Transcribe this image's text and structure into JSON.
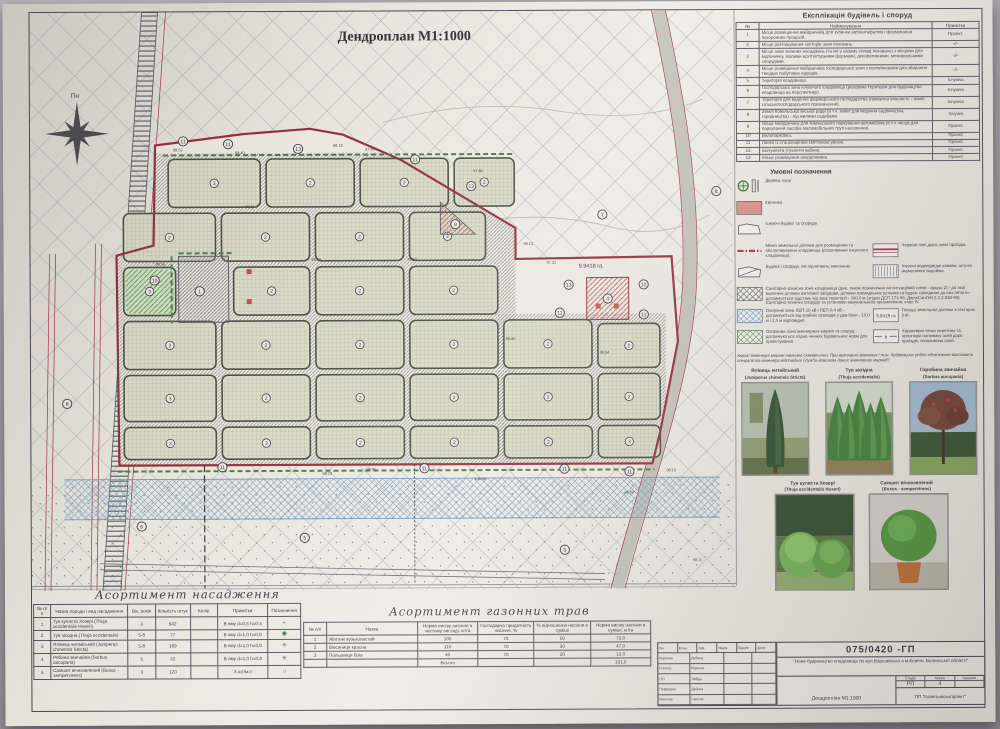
{
  "plan": {
    "title": "Дендроплан М1:1000",
    "north_label": "Пн",
    "area_label": "9.9418 га.",
    "sectors": [
      [
        165,
        156,
        92,
        48,
        "3",
        0
      ],
      [
        263,
        156,
        88,
        48,
        "2",
        0
      ],
      [
        357,
        156,
        88,
        48,
        "2",
        0
      ],
      [
        451,
        156,
        60,
        48,
        "2",
        0
      ],
      [
        120,
        210,
        92,
        48,
        "2",
        0
      ],
      [
        218,
        210,
        88,
        48,
        "2",
        0
      ],
      [
        312,
        210,
        88,
        48,
        "2",
        0
      ],
      [
        406,
        210,
        76,
        48,
        "2",
        0
      ],
      [
        120,
        264,
        52,
        48,
        "3",
        1
      ],
      [
        230,
        264,
        76,
        48,
        "2",
        0
      ],
      [
        312,
        264,
        88,
        48,
        "2",
        0
      ],
      [
        406,
        264,
        88,
        48,
        "2",
        0
      ],
      [
        120,
        318,
        92,
        48,
        "2",
        0
      ],
      [
        218,
        318,
        88,
        48,
        "2",
        0
      ],
      [
        312,
        318,
        88,
        48,
        "2",
        0
      ],
      [
        406,
        318,
        88,
        48,
        "2",
        0
      ],
      [
        500,
        318,
        88,
        48,
        "2",
        0
      ],
      [
        594,
        322,
        62,
        44,
        "2",
        0
      ],
      [
        120,
        372,
        92,
        46,
        "3",
        0
      ],
      [
        218,
        372,
        88,
        46,
        "2",
        0
      ],
      [
        312,
        372,
        88,
        46,
        "2",
        0
      ],
      [
        406,
        372,
        88,
        46,
        "2",
        0
      ],
      [
        500,
        372,
        88,
        46,
        "2",
        0
      ],
      [
        594,
        372,
        62,
        46,
        "2",
        0
      ],
      [
        120,
        424,
        92,
        32,
        "3",
        0
      ],
      [
        218,
        424,
        88,
        32,
        "3",
        0
      ],
      [
        312,
        424,
        88,
        32,
        "2",
        0
      ],
      [
        406,
        424,
        88,
        32,
        "2",
        0
      ],
      [
        500,
        424,
        88,
        32,
        "2",
        0
      ],
      [
        594,
        424,
        62,
        32,
        "3",
        0
      ]
    ],
    "markers": [
      [
        180,
        138,
        "11"
      ],
      [
        225,
        141,
        "11"
      ],
      [
        295,
        146,
        "13"
      ],
      [
        412,
        157,
        "11"
      ],
      [
        468,
        184,
        "13"
      ],
      [
        452,
        222,
        "9"
      ],
      [
        151,
        277,
        "10"
      ],
      [
        196,
        288,
        "1"
      ],
      [
        599,
        213,
        "7"
      ],
      [
        713,
        190,
        "8"
      ],
      [
        565,
        283,
        "13"
      ],
      [
        640,
        283,
        "12"
      ],
      [
        604,
        297,
        "4"
      ],
      [
        556,
        311,
        "11"
      ],
      [
        640,
        313,
        "11"
      ],
      [
        218,
        464,
        "11"
      ],
      [
        420,
        466,
        "11"
      ],
      [
        560,
        467,
        "11"
      ],
      [
        625,
        470,
        "11"
      ],
      [
        137,
        523,
        "6"
      ],
      [
        300,
        535,
        "5"
      ],
      [
        560,
        548,
        "5"
      ],
      [
        63,
        400,
        "8"
      ]
    ],
    "elevations": [
      [
        170,
        148,
        "98.52"
      ],
      [
        232,
        151,
        "98.40"
      ],
      [
        330,
        144,
        "98.18"
      ],
      [
        362,
        148,
        "97.65"
      ],
      [
        470,
        170,
        "97.88"
      ],
      [
        520,
        243,
        "98.13"
      ],
      [
        543,
        262,
        "97.31"
      ],
      [
        152,
        262,
        "98.56"
      ],
      [
        308,
        258,
        "98.34"
      ],
      [
        404,
        258,
        "98.12"
      ],
      [
        502,
        338,
        "98.86"
      ],
      [
        596,
        352,
        "98.84"
      ],
      [
        318,
        472,
        "98.23"
      ],
      [
        362,
        468,
        "98.91"
      ],
      [
        470,
        478,
        "100.08"
      ],
      [
        620,
        492,
        "98.56"
      ],
      [
        662,
        470,
        "98.15"
      ],
      [
        688,
        560,
        "98.11"
      ],
      [
        242,
        205,
        "98.11"
      ]
    ]
  },
  "explication": {
    "title": "Експлікація будівель і споруд",
    "headers": [
      "№",
      "Найменування",
      "Примітки"
    ],
    "rows": [
      {
        "n": "1",
        "name": "Місце розміщення майданчика для зупинки автокатафалків і формування похоронних процесій.",
        "note": "Проект."
      },
      {
        "n": "2",
        "name": "Місце розташування секторів зони поховань.",
        "note": "-//-"
      },
      {
        "n": "3",
        "name": "Місце зони зелених насаджень (та які у своєму складі поховань) з місцями для відпочинку, малими архітектурними формами, декоративними, меморіальними спорудами.",
        "note": "-//-"
      },
      {
        "n": "4",
        "name": "Місце розміщення майданчика господарської зони з контейнерами для збирання твердих побутових відходів.",
        "note": "-//-"
      },
      {
        "n": "5",
        "name": "Територія кладовища.",
        "note": "Існуюча"
      },
      {
        "n": "6",
        "name": "Господарська зона існуючого кладовища (резервна територія для будівництва кладовища на перспективу).",
        "note": "Існуюча"
      },
      {
        "n": "7",
        "name": "Територія для ведення фермерського господарства (приватна власність - землі сільськогосподарського призначення).",
        "note": "Існуюча"
      },
      {
        "n": "8",
        "name": "Землі Ковельської міської ради (в т.ч. землі для ведення садівництва, городництва) - під жилими садибами.",
        "note": "Існуючі"
      },
      {
        "n": "9",
        "name": "Місце майданчика для тимчасового паркування автомобілів (в т.ч. місця для паркування засобів маломобільних груп населення).",
        "note": "Проект."
      },
      {
        "n": "10",
        "name": "Велопарковка.",
        "note": "Проект."
      },
      {
        "n": "11",
        "name": "Лавка із стаціонарною сміттєвою урною.",
        "note": "Проект."
      },
      {
        "n": "12",
        "name": "Біотуалети (туалетні кабіни).",
        "note": "Проект."
      },
      {
        "n": "13",
        "name": "Місце розміщення свердловини.",
        "note": "Проект."
      }
    ]
  },
  "legend": {
    "title": "Умовні позначення",
    "rows": [
      {
        "left": {
          "icon": "trees",
          "text": "Дерева, кущі"
        }
      },
      {
        "left": {
          "icon": "flowerbed",
          "text": "Квітники"
        }
      },
      {
        "left": {
          "icon": "building",
          "text": "Існуючі будівлі та споруди"
        }
      },
      {
        "left": {
          "icon": "boundary",
          "text": "Межа земельної ділянки для розміщення та обслуговування кладовища (розширення існуючого кладовища)."
        },
        "right": {
          "icon": "redlines",
          "text": "Червоні лінії доріг, межі проїздів."
        }
      },
      {
        "left": {
          "icon": "demolish",
          "text": "Будівлі і споруди, які підлягають знесенню."
        },
        "right": {
          "icon": "ditch",
          "text": "Існуючі водовідвідні канави, штучні акумулюючі водойми."
        }
      },
      {
        "wide": {
          "icon": "szz",
          "text": "Санітарно-захисна зона кладовища (див. також позначення на ситуаційній схемі - аркуш 2) - до якої включені ділянки житлової забудови, ділянки громадських установ та будов, приєднані до них об'єкти - дотримується відстань від меж території - 300,0 м (згідно ДСП 173-96, ДержСанПіН 2.2.2.028-99). Санітарно-технічні споруди та установки комунального призначення, клас ІV."
        }
      },
      {
        "left": {
          "icon": "lep",
          "text": "Охоронні зони ЛЕП-10 кВ і ЛЕП-0,4 кВ - дотримуються від крайніх проводів у два боки - 10,0 м і 2,0 м відповідно."
        },
        "right": {
          "icon": "area",
          "text": "Площа земельної ділянки в гектарах (га)."
        }
      },
      {
        "left": {
          "icon": "network",
          "text": "Охоронна зона інженерних мереж та споруд - дотримуються згідно чинних будівельних норм для проектування."
        },
        "right": {
          "icon": "axis",
          "text": "Характерні точки перетину та орієнтири напрямку осей доріг, проїздів, позначення осей."
        }
      }
    ],
    "area_icon_text": "9.9418 га",
    "axis_icon_text": "в",
    "note": "Увага! Інженерні мережі нанесені схематично. При виконанні земляних і т.ін. будівельних робіт обов'язково викликати спеціаліста-інженера відповідної служби-власника даних інженерних мереж!!!"
  },
  "plants": [
    {
      "name": "Ялівець китайський",
      "latin": "(Juniperus chinensis Stricta)",
      "photo": "juniper"
    },
    {
      "name": "Туя західна",
      "latin": "(Thuja occidentalis)",
      "photo": "thuja"
    },
    {
      "name": "Горобина звичайна",
      "latin": "(Sorbus aucuparia)",
      "photo": "rowan"
    },
    {
      "name": "Туя куляста Хозері",
      "latin": "(Thuja occidentalis Hoseri)",
      "photo": "hoseri"
    },
    {
      "name": "Самшит вічнозелений",
      "latin": "(Buxus - sempervirens)",
      "photo": "buxus"
    }
  ],
  "assortment": {
    "title": "Асортимент насадження",
    "headers": [
      "№ п/п",
      "Назва породи і вид насадження",
      "Вік, років",
      "Кількість штук",
      "Колір",
      "Примітки",
      "Позначення"
    ],
    "rows": [
      {
        "n": "1",
        "name": "Туя куляста Хозері (Thuja occidentalis Hoseri)",
        "age": "3",
        "qty": "642",
        "color": "",
        "note": "В яму d=0,5 h=0,4",
        "sym": "dots-green"
      },
      {
        "n": "2",
        "name": "Туя західна (Thuja occidentalis)",
        "age": "5-8",
        "qty": "77",
        "color": "",
        "note": "В яму d=1,0 h=0,8",
        "sym": "circle-green"
      },
      {
        "n": "3",
        "name": "Ялівець китайський (Juniperus chinensis Stricta)",
        "age": "5-8",
        "qty": "169",
        "color": "",
        "note": "В яму d=1,0 h=0,8",
        "sym": "star-green"
      },
      {
        "n": "4",
        "name": "Рябина звичайна (Sorbus aucuparia)",
        "age": "5",
        "qty": "42",
        "color": "",
        "note": "В яму d=1,0 h=0,8",
        "sym": "star-red"
      },
      {
        "n": "5",
        "name": "Самшит вічнозелений (Buxus - sempervirens)",
        "age": "3",
        "qty": "120",
        "color": "",
        "note": "3 шт/м.п",
        "sym": "circle-open"
      }
    ]
  },
  "grass": {
    "title": "Асортимент газонних трав",
    "headers": [
      "№ п/п",
      "Назва",
      "Норма висіву насіння в чистому вигляді, кг/га",
      "Господарча придатність насіння, %",
      "% відношення насіння в суміші",
      "Норма висіву насіння в суміші, кг/га"
    ],
    "rows": [
      {
        "n": "1",
        "name": "Житняк вузьколистий",
        "norm": "100",
        "quality": "70",
        "ratio": "50",
        "mix": "72,0"
      },
      {
        "n": "2",
        "name": "Вівсяниця красна",
        "norm": "110",
        "quality": "70",
        "ratio": "30",
        "mix": "47,0"
      },
      {
        "n": "3",
        "name": "Польовиця біла",
        "norm": "40",
        "quality": "70",
        "ratio": "20",
        "mix": "12,0"
      }
    ],
    "total_label": "Всього",
    "total_value": "131,0"
  },
  "titleblock": {
    "code": "075/0420 -ГП",
    "project": "\"Нове будівництво кладовища по вул.Варшавська в м.Ковель Волинської області\"",
    "rev_headers": [
      "Зм.",
      "Кільк.",
      "Арк.",
      "№док.",
      "Підпис",
      "Дата"
    ],
    "staff": [
      {
        "role": "Керівник",
        "name": "Дубина"
      },
      {
        "role": "Н.контр.",
        "name": "Коренга"
      },
      {
        "role": "ГІП",
        "name": "Лебідь"
      },
      {
        "role": "Перевірив",
        "name": "Дубина"
      },
      {
        "role": "Виконав",
        "name": "Сметюк"
      }
    ],
    "stage_headers": [
      "Стадія",
      "Аркуш",
      "Аркушів"
    ],
    "stage": "РП",
    "sheet": "4",
    "sheets": "",
    "doc_title": "Дендроплан М1:1000",
    "company": "ПП \"Ковельміськпроект\""
  },
  "colors": {
    "boundary_red": "#93303e",
    "hatch_gray": "#aab0b8",
    "sector_fill": "#d9d9c6",
    "hedge_green": "#4e7d46",
    "water_blue": "#5f93bd"
  }
}
